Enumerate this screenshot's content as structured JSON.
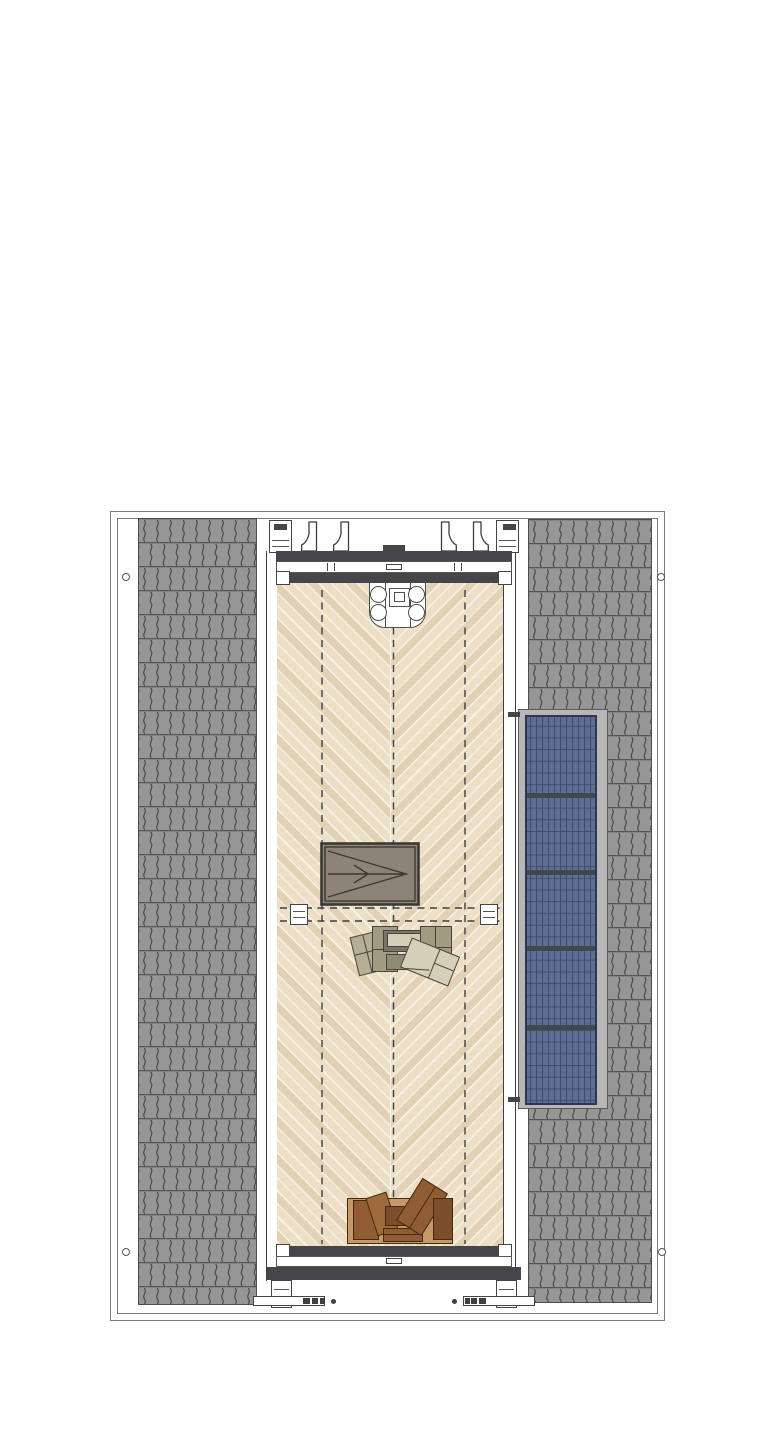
{
  "page": {
    "kind": "architectural roof plan drawing",
    "notes": "plan view of a pitched-roof building: two grey shingle roof slopes, central timber roof terrace with herringbone decking, roof access hatch with direction arrow, lounge seating group, dining table with four stools, firewood storage, and a five-section solar panel array; no text labels are rendered"
  },
  "colors": {
    "outline": "#7a7a7a",
    "ink": "#3f3f3f",
    "roof_base": "#969696",
    "roof_line": "#4c4c4c",
    "deck_base": "#ecdfc6",
    "deck_stripe": "rgba(255,255,255,0.6)",
    "deck_band": "rgba(186,152,105,0.2)",
    "beam_dark": "#45454a",
    "hatch_fill": "#8d8477",
    "hatch_line": "#3c3a35",
    "solar_blue": "#5e6d93",
    "solar_grid": "#394563",
    "solar_divider": "#42474e",
    "solar_frame": "#b7b7b7",
    "furniture_olive": "#a29b82",
    "furniture_tan": "#b6ae94",
    "furniture_beige": "#d6cfb7",
    "furniture_gray": "#76756c",
    "wood_dark": "#7c4e2b",
    "wood_mid": "#8f5c33",
    "wood_light": "#a06b3a",
    "wood_bg": "#c49869"
  },
  "plan": {
    "left_roof": {
      "material": "shingle-tiles"
    },
    "right_roof": {
      "material": "shingle-tiles"
    },
    "solar_array": {
      "sections": 5
    },
    "deck": {
      "pattern": "herringbone",
      "guide_lines": 3
    },
    "roof_hatch": {
      "arrow_direction": "right"
    },
    "dining_set": {
      "seats": 4
    },
    "lounge_set": {
      "pieces": 7
    },
    "wood_storage": {
      "crates": 6
    },
    "corner_markers": 4
  }
}
